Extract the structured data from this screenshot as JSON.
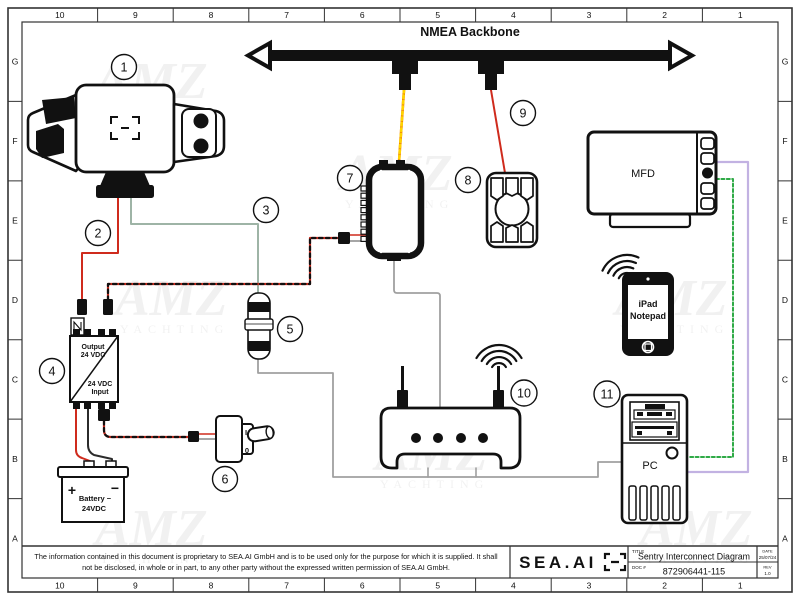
{
  "sheet": {
    "grid_cols": [
      "10",
      "9",
      "8",
      "7",
      "6",
      "5",
      "4",
      "3",
      "2",
      "1"
    ],
    "grid_rows": [
      "G",
      "F",
      "E",
      "D",
      "C",
      "B",
      "A"
    ]
  },
  "diagram": {
    "backbone_label": "NMEA Backbone",
    "callouts": [
      "1",
      "2",
      "3",
      "4",
      "5",
      "6",
      "7",
      "8",
      "9",
      "10",
      "11"
    ],
    "converter": {
      "out1": "Output",
      "out2": "24 VDC",
      "in1": "24 VDC",
      "in2": "Input"
    },
    "battery": {
      "plus": "+",
      "minus": "−",
      "name": "Battery −",
      "voltage": "24VDC"
    },
    "switch": {
      "on": "I",
      "off": "0"
    },
    "mfd_label": "MFD",
    "tablet_line1": "iPad",
    "tablet_line2": "Notepad",
    "pc_label": "PC"
  },
  "titleblock": {
    "disclaimer1": "The information contained in this document is proprietary to SEA.AI GmbH and is to be used only for the purpose for which it is supplied. It shall",
    "disclaimer2": "not be disclosed, in whole or in part, to any other party without the expressed written permission of SEA.AI GmbH.",
    "logo_text": "SEA.AI",
    "title_label": "TITLE",
    "title": "Sentry Interconnect Diagram",
    "doc_label": "DOC #",
    "doc_number": "872906441-115",
    "date_label": "DATE",
    "date_value": "25/07/24",
    "rev_label": "REV",
    "rev_value": "1.0"
  },
  "watermark": {
    "line1": "AMZ",
    "line2": "YACHTING"
  },
  "colors": {
    "red_wire": "#cf2b1d",
    "black_wire": "#2b2b2b",
    "sage_wire": "#9eb4a6",
    "gray_wire": "#a0a0a0",
    "purple_wire": "#c2b2e2",
    "green_wire": "#2faa46",
    "orange_wire": "#f07800",
    "orange_dash": "#ffd400"
  }
}
